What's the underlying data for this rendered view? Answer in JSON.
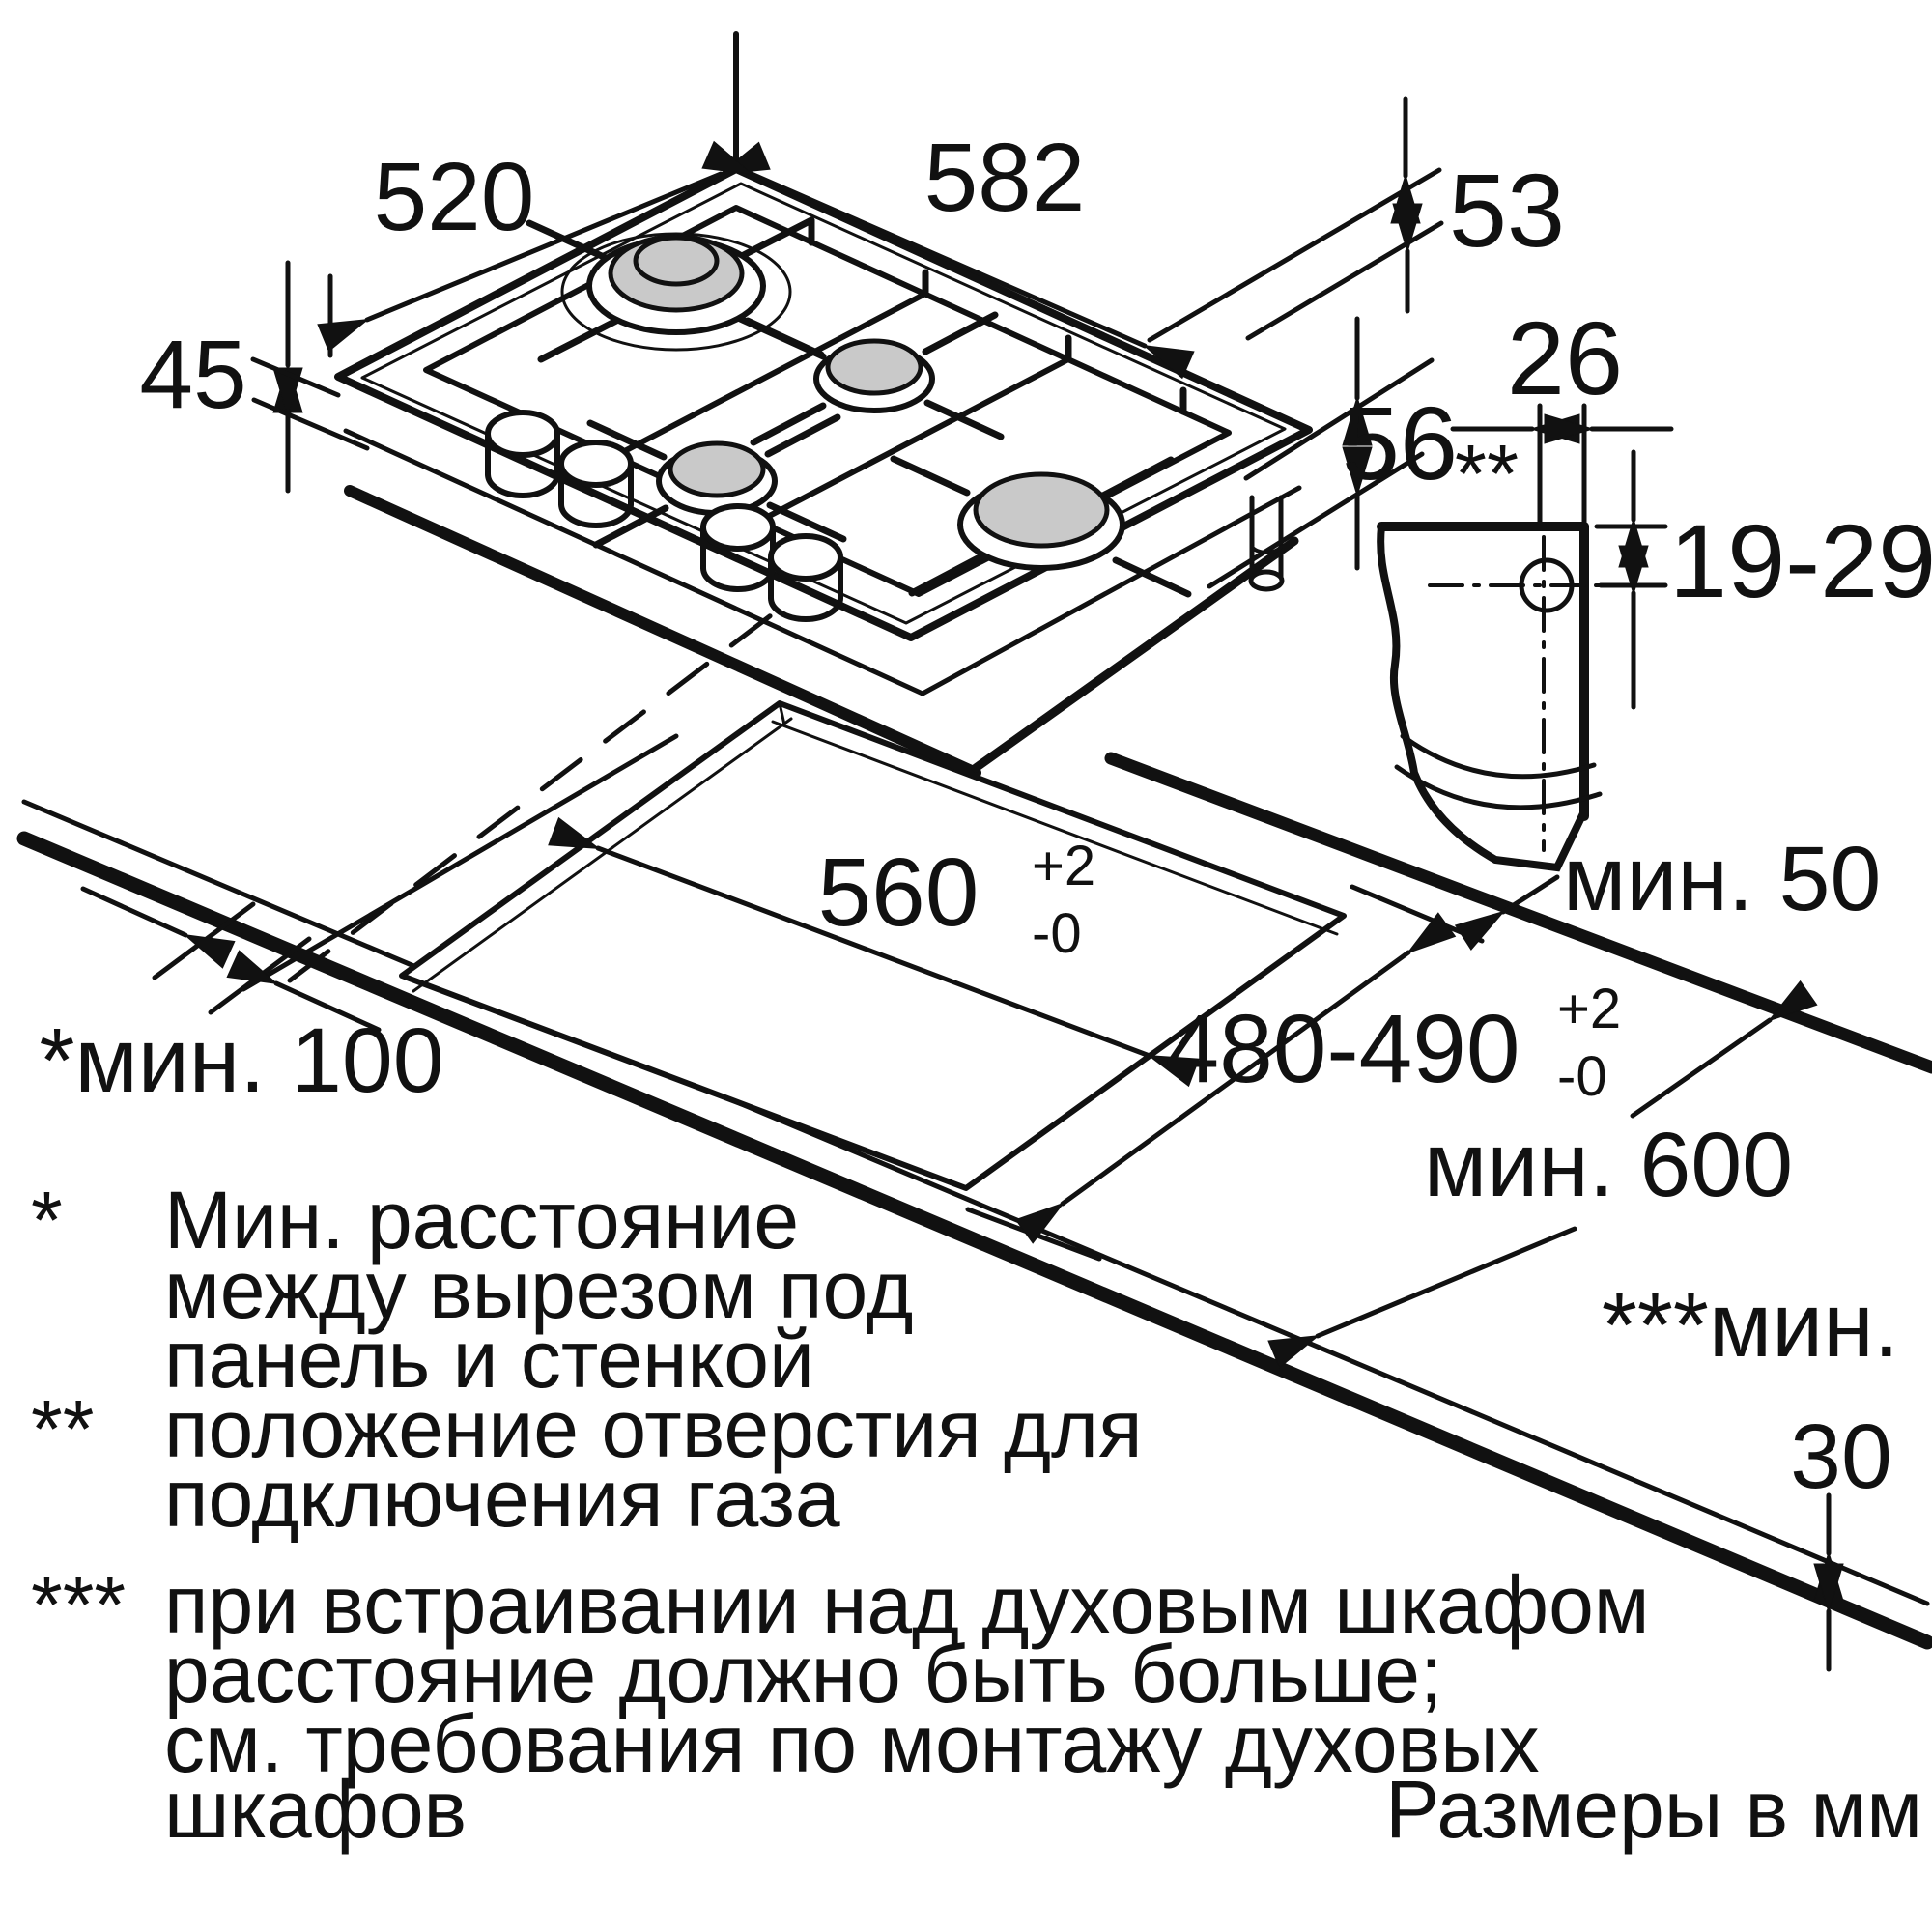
{
  "title_hidden": "Схема встраивания газовой варочной панели",
  "units_note": "Размеры в мм",
  "dims": {
    "hob_width": "582",
    "hob_depth": "520",
    "hob_build_in_height": "45",
    "edge_53": "53",
    "edge_56": "56",
    "hole_offset_26": "26",
    "hole_offset_19_29": "19-29",
    "gas_hole_marker": "**",
    "cutout_width": "560",
    "cutout_width_tol_plus": "+2",
    "cutout_width_tol_minus": "-0",
    "cutout_depth": "480-490",
    "cutout_depth_tol_plus": "+2",
    "cutout_depth_tol_minus": "-0",
    "min_wall": "*мин. 100",
    "min_side": "мин. 50",
    "min_worktop_depth": "мин. 600",
    "min_bottom_prefix": "***мин.",
    "min_bottom_value": "30"
  },
  "footnotes": {
    "marker1": "*",
    "f1_line1": "Мин. расстояние",
    "f1_line2": "между вырезом под",
    "f1_line3": "панель и стенкой",
    "marker2": "**",
    "f2_line1": "положение отверстия для",
    "f2_line2": "подключения газа",
    "marker3": "***",
    "f3_line1": "при встраивании над духовым шкафом",
    "f3_line2": "расстояние должно быть больше;",
    "f3_line3": "см. требования по монтажу духовых",
    "f3_line4": "шкафов"
  }
}
